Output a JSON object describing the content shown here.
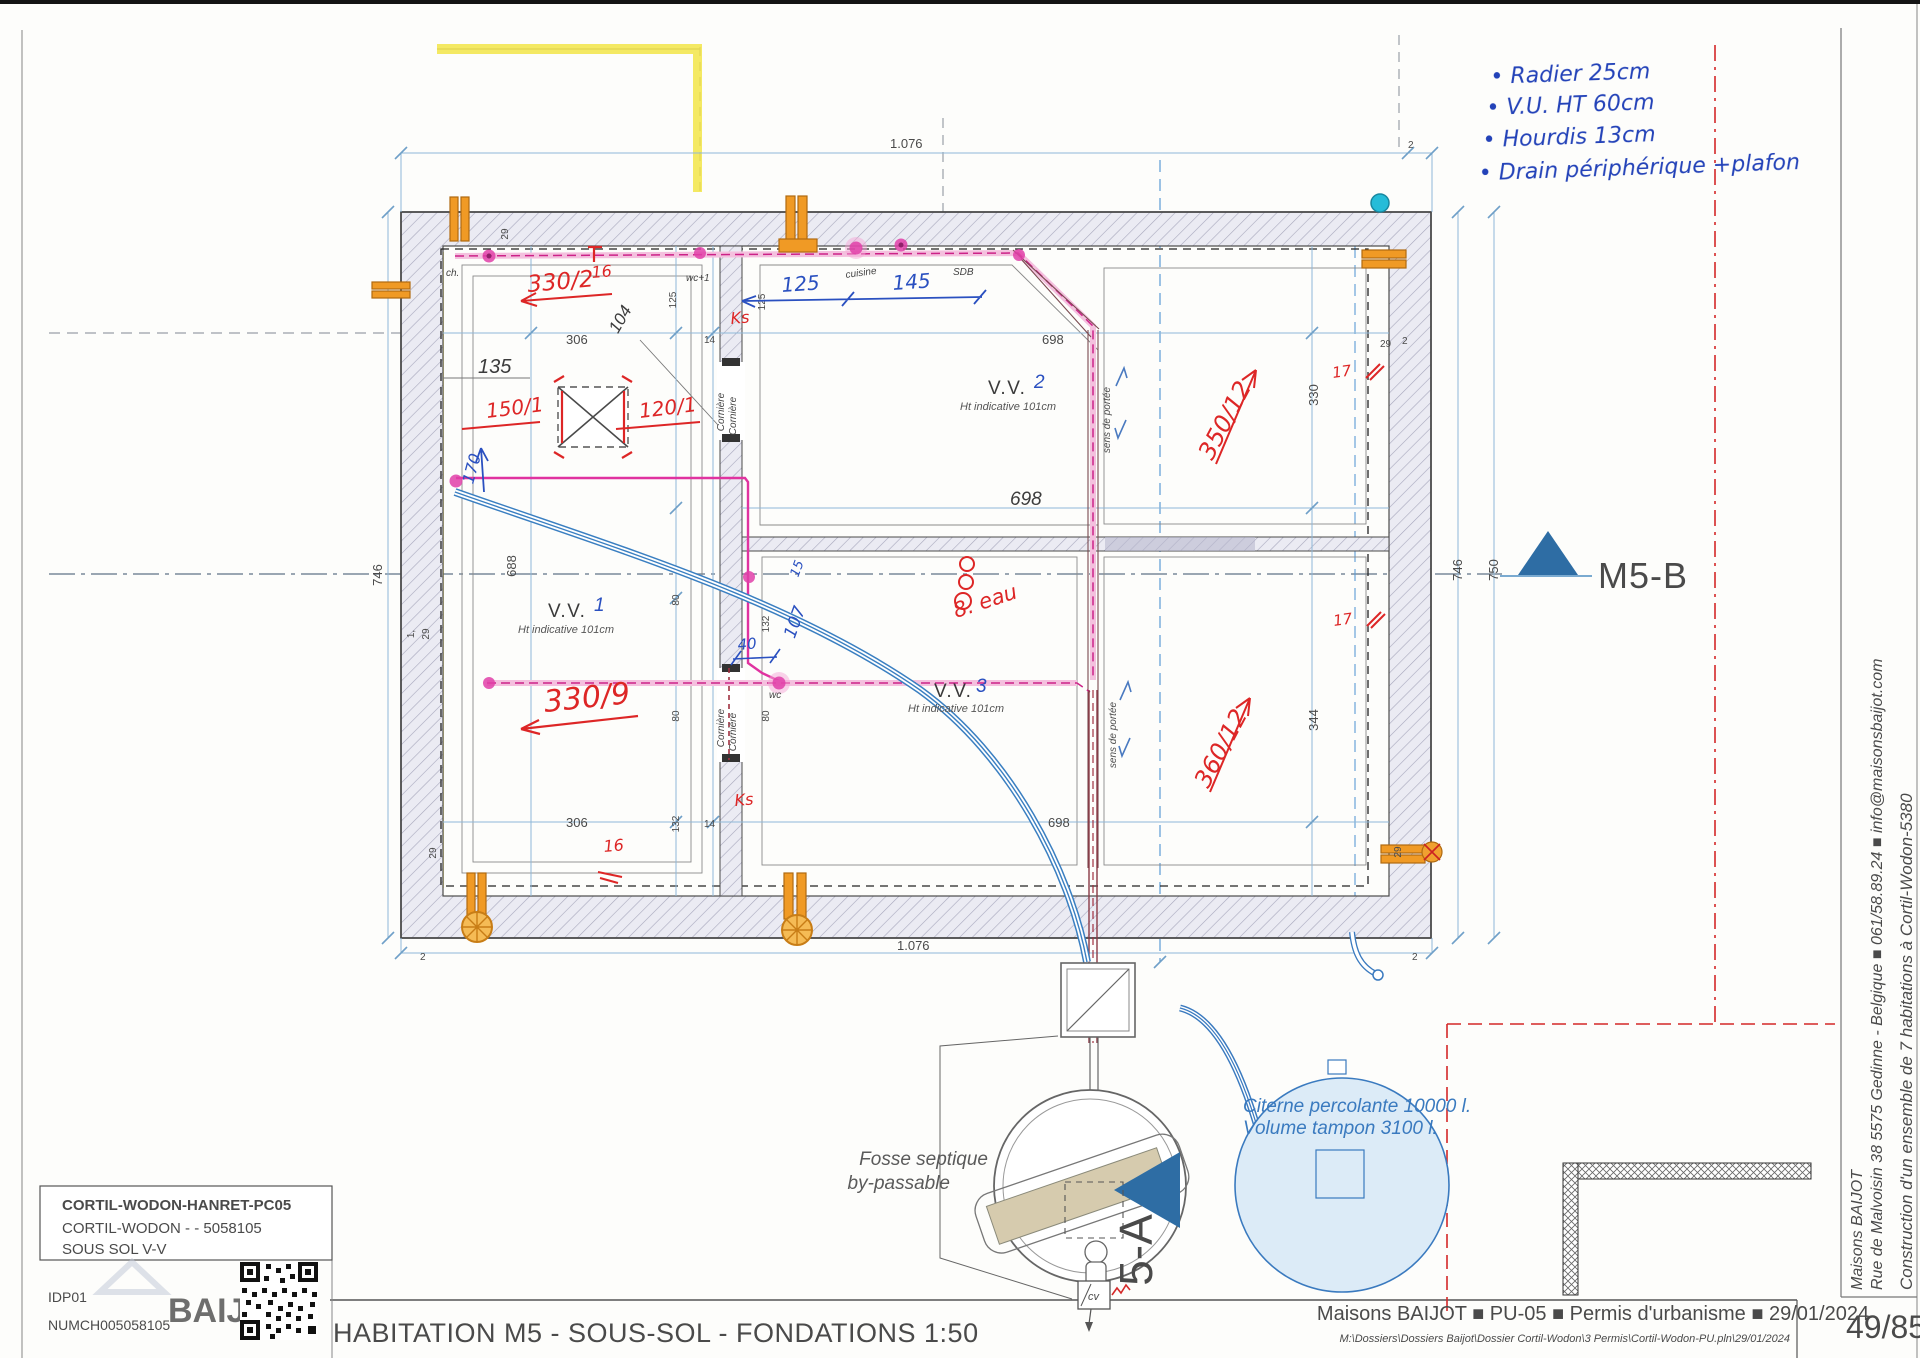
{
  "colors": {
    "accent_red": "#dd2626",
    "hand_blue": "#2342b8",
    "pipe_magenta": "#e03aa4",
    "pipe_maroon": "#8a3a45",
    "pipe_blue": "#3a7fc1",
    "cistern_blue": "#3a7abf",
    "orange": "#f09a25",
    "highlight_yellow": "#f2e43e",
    "triangle_blue": "#2e6da4"
  },
  "handnotes": [
    "• Radier 25cm",
    "• V.U. HT 60cm",
    "• Hourdis 13cm",
    "• Drain périphérique +plafon"
  ],
  "marker": {
    "label": "M5-B"
  },
  "rooms": [
    {
      "name": "V.V.",
      "num": "1",
      "sub": "Ht indicative 101cm"
    },
    {
      "name": "V.V.",
      "num": "2",
      "sub": "Ht indicative 101cm"
    },
    {
      "name": "V.V.",
      "num": "3",
      "sub": "Ht indicative 101cm"
    }
  ],
  "red": {
    "a330_2": "330/2",
    "sup16": "16",
    "a150": "150/1",
    "a120": "120/1",
    "a330_9": "330/9",
    "a350": "350/12",
    "a360": "360/12",
    "eau": "8. eau",
    "ks1": "Ks",
    "ks2": "Ks",
    "s17a": "17",
    "s17b": "17",
    "b16": "16"
  },
  "blue": {
    "d125": "125",
    "d145": "145",
    "d170": "170",
    "d40": "40",
    "d107": "107",
    "d15": "15"
  },
  "labels": {
    "ch": "ch.",
    "wc1": "wc+1",
    "cuisine": "cuisine",
    "sdb": "SDB",
    "wc": "wc",
    "corniere": "Cornière",
    "sens": "sens de portée"
  },
  "dims": [
    "1.076",
    "2",
    "746",
    "688",
    "1.076",
    "2",
    "2",
    "746",
    "750",
    "306",
    "135",
    "104",
    "125",
    "14",
    "698",
    "698",
    "698",
    "306",
    "132",
    "14",
    "330",
    "344",
    "80",
    "80",
    "80",
    "132",
    "29",
    "29",
    "2",
    "29",
    "29",
    "1,",
    "29",
    "125"
  ],
  "septic": {
    "label1": "Fosse septique",
    "label2": "by-passable",
    "tag": "5-A",
    "cv": "cv"
  },
  "cistern": {
    "line1": "Citerne percolante 10000 l.",
    "line2": "Volume tampon 3100 l."
  },
  "project_box": {
    "l1": "CORTIL-WODON-HANRET-PC05",
    "l2": "CORTIL-WODON -  - 5058105",
    "l3": "SOUS SOL V-V",
    "l4": "IDP01",
    "l5": "NUMCH005058105",
    "watermark": "BAIJ"
  },
  "footer": {
    "title": "HABITATION M5 - SOUS-SOL - FONDATIONS 1:50",
    "meta": "Maisons BAIJOT  ■  PU-05  ■  Permis d'urbanisme  ■  29/01/2024",
    "path": "M:\\Dossiers\\Dossiers Baijot\\Dossier Cortil-Wodon\\3 Permis\\Cortil-Wodon-PU.pln\\29/01/2024",
    "page": "49/85"
  },
  "sidebar": {
    "company": "Maisons BAIJOT",
    "address": "Rue de Malvoisin 38 5575 Gedinne - Belgique ■ 061/58.89.24 ■ info@maisonsbaijot.com",
    "project": "Construction d'un ensemble de 7 habitations à Cortil-Wodon-5380"
  }
}
